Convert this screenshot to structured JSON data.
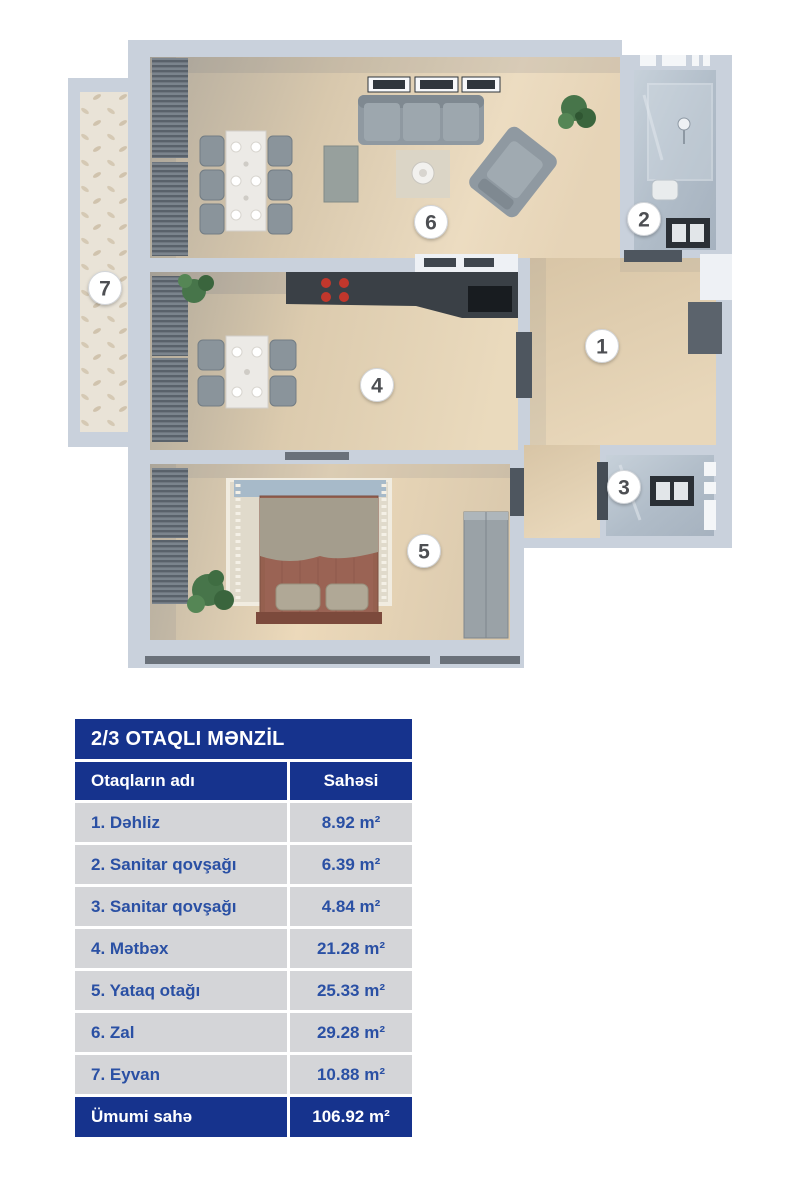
{
  "plan": {
    "markers": [
      "1",
      "2",
      "3",
      "4",
      "5",
      "6",
      "7"
    ],
    "icons": [
      "sofa",
      "armchair",
      "dining-table",
      "kitchen-counter",
      "stove-burners",
      "bed",
      "rug",
      "wardrobe",
      "plant",
      "curtains",
      "shower",
      "sink",
      "toilet",
      "entrance-door"
    ]
  },
  "table": {
    "title": "2/3 OTAQLI MƏNZİL",
    "columns": [
      "Otaqların adı",
      "Sahəsi"
    ],
    "rows": [
      {
        "name": "1. Dəhliz",
        "area": "8.92 m²"
      },
      {
        "name": "2. Sanitar qovşağı",
        "area": "6.39 m²"
      },
      {
        "name": "3. Sanitar qovşağı",
        "area": "4.84 m²"
      },
      {
        "name": "4. Mətbəx",
        "area": "21.28 m²"
      },
      {
        "name": "5. Yataq otağı",
        "area": "25.33 m²"
      },
      {
        "name": "6. Zal",
        "area": "29.28 m²"
      },
      {
        "name": "7. Eyvan",
        "area": "10.88 m²"
      }
    ],
    "footer": {
      "name": "Ümumi sahə",
      "area": "106.92 m²"
    }
  },
  "colors": {
    "navy": "#16338d",
    "row_bg": "#d4d5d8",
    "row_text": "#2a50a4",
    "wall": "#c9d1dc",
    "wood_floor": "#e9d8bc",
    "marble_floor": "#b7c2ce"
  }
}
